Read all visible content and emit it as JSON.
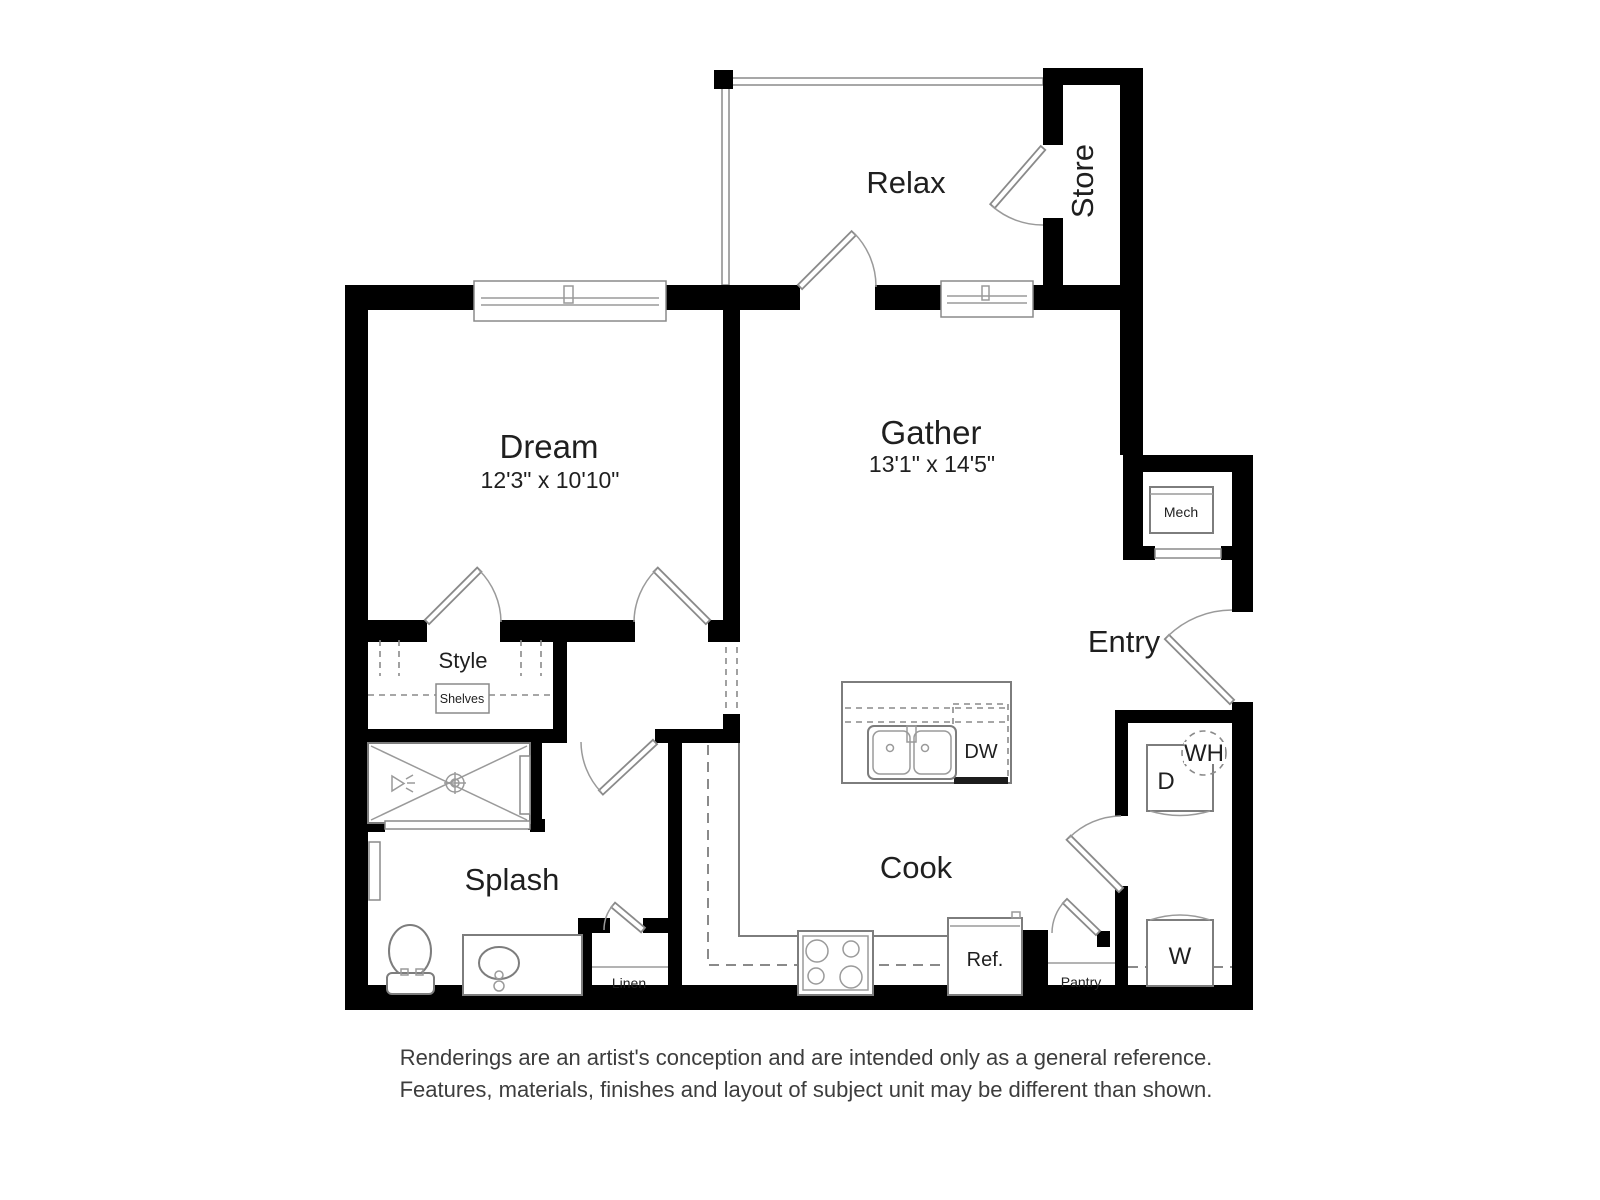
{
  "floor_plan": {
    "rooms": {
      "relax": {
        "label": "Relax"
      },
      "store": {
        "label": "Store"
      },
      "dream": {
        "label": "Dream",
        "dims": "12'3\" x 10'10\""
      },
      "gather": {
        "label": "Gather",
        "dims": "13'1\" x 14'5\""
      },
      "entry": {
        "label": "Entry"
      },
      "style": {
        "label": "Style"
      },
      "splash": {
        "label": "Splash"
      },
      "cook": {
        "label": "Cook"
      }
    },
    "labels": {
      "mech": "Mech",
      "shelves": "Shelves",
      "linen": "Linen",
      "pantry": "Pantry",
      "refrigerator": "Ref.",
      "dishwasher": "DW",
      "washer": "W",
      "dryer": "D",
      "water_heater": "WH"
    },
    "colors": {
      "wall": "#000000",
      "fixture_line": "#7d7d7d",
      "label_text": "#1f1f1f",
      "disclaimer_text": "#3d3d3d"
    }
  },
  "disclaimer": {
    "line1": "Renderings are an artist's conception and are intended only as a general reference.",
    "line2": "Features, materials, finishes and layout of subject unit may be different than shown."
  }
}
